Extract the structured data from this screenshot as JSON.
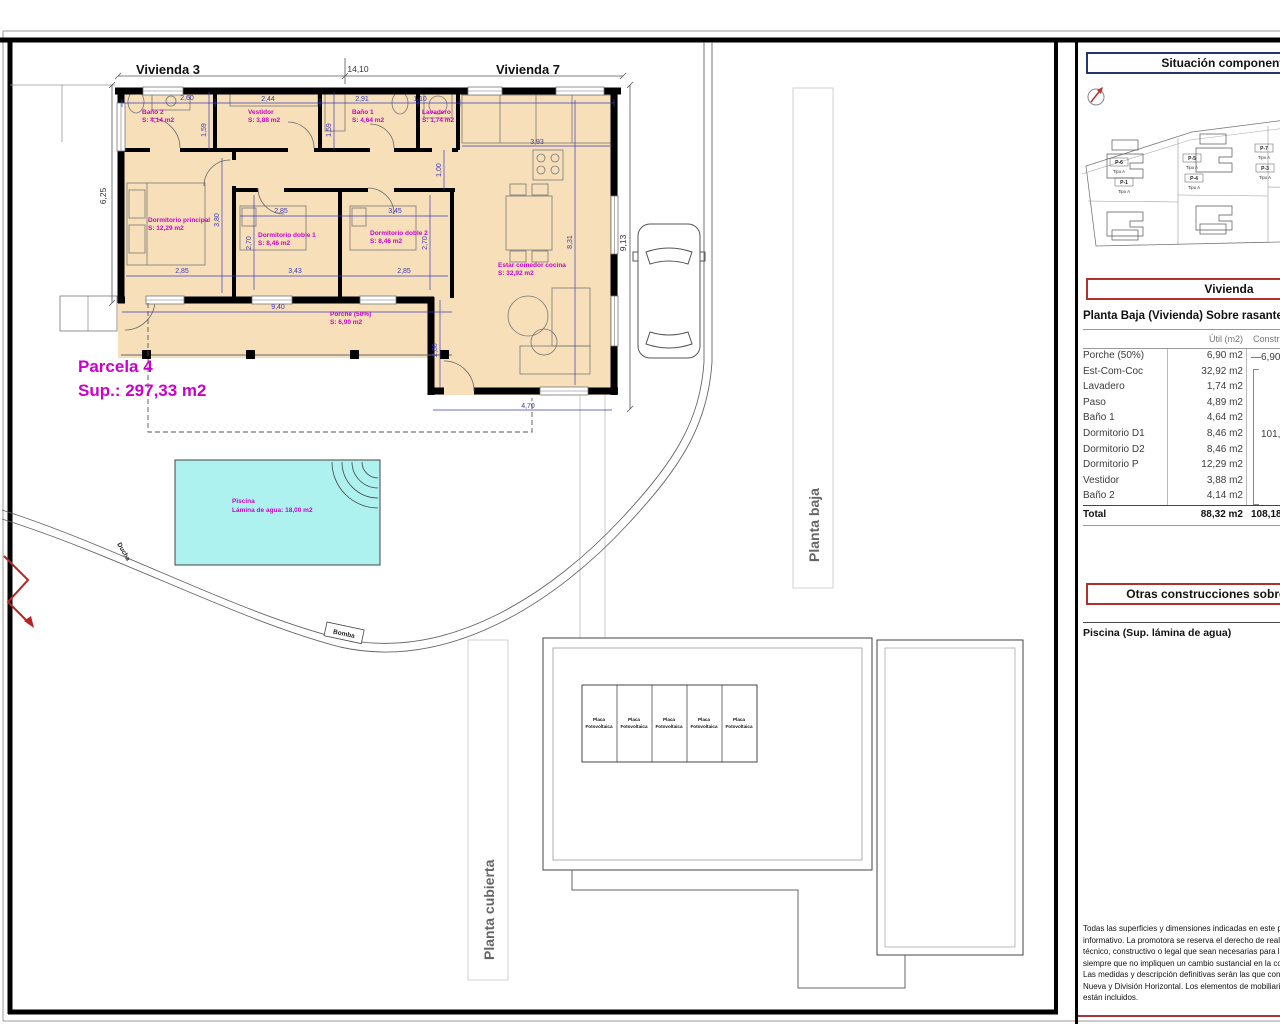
{
  "colors": {
    "room_label_magenta": "#cc00cc",
    "dimension_blue": "#3b3bbb",
    "pool_cyan": "#aef2f0",
    "floor_peach": "#f7dfba",
    "wall_black": "#000000",
    "header_navy_border": "#23366e",
    "header_red_border": "#b03030",
    "north_arrow_red": "#bb3333"
  },
  "plan": {
    "titles": {
      "vivienda3": "Vivienda 3",
      "vivienda7": "Vivienda 7"
    },
    "parcela": {
      "name": "Parcela 4",
      "area": "Sup.: 297,33 m2"
    },
    "rooms": [
      {
        "name": "Baño 2",
        "area": "S: 4,14 m2"
      },
      {
        "name": "Vestidor",
        "area": "S: 3,88 m2"
      },
      {
        "name": "Baño 1",
        "area": "S: 4,64 m2"
      },
      {
        "name": "Lavadero",
        "area": "S: 1,74 m2"
      },
      {
        "name": "Dormitorio principal",
        "area": "S: 12,29 m2"
      },
      {
        "name": "Dormitorio doble 1",
        "area": "S: 8,46 m2"
      },
      {
        "name": "Dormitorio doble 2",
        "area": "S: 8,46 m2"
      },
      {
        "name": "Estar comedor cocina",
        "area": "S: 32,92 m2"
      },
      {
        "name": "Porche (50%)",
        "area": "S: 6,90 m2"
      }
    ],
    "pool": {
      "name": "Piscina",
      "area": "Lámina de agua: 18,00 m2"
    },
    "site_labels": {
      "ducha": "Ducha",
      "bomba": "Bomba"
    },
    "view_labels": {
      "planta_baja": "Planta baja",
      "planta_cubierta": "Planta cubierta"
    },
    "solar": {
      "line1": "Placa",
      "line2": "Fotovoltaica"
    },
    "dims": [
      "14,10",
      "6,25",
      "9,13",
      "2,60",
      "2,44",
      "2,91",
      "1,10",
      "3,93",
      "1,59",
      "1,59",
      "1,00",
      "3,80",
      "2,85",
      "2,70",
      "3,43",
      "3,45",
      "2,70",
      "2,85",
      "2,85",
      "9,40",
      "8,31",
      "2,80",
      "4,70"
    ]
  },
  "panel": {
    "situacion_title": "Situación componentes",
    "site_plan": {
      "plots": [
        {
          "id": "P-6",
          "tipo": "Tipo A"
        },
        {
          "id": "P-1",
          "tipo": "Tipo A"
        },
        {
          "id": "P-5",
          "tipo": "Tipo A"
        },
        {
          "id": "P-4",
          "tipo": "Tipo A"
        },
        {
          "id": "P-7",
          "tipo": "Tipo A"
        },
        {
          "id": "P-3",
          "tipo": "Tipo A"
        }
      ]
    },
    "vivienda_title": "Vivienda",
    "planta_baja_heading": "Planta Baja (Vivienda) Sobre rasante",
    "table": {
      "col_util": "Útil (m2)",
      "col_construido": "Construido (m2)",
      "rows": [
        {
          "label": "Porche (50%)",
          "util": "6,90 m2"
        },
        {
          "label": "Est-Com-Coc",
          "util": "32,92 m2"
        },
        {
          "label": "Lavadero",
          "util": "1,74 m2"
        },
        {
          "label": "Paso",
          "util": "4,89 m2"
        },
        {
          "label": "Baño 1",
          "util": "4,64 m2"
        },
        {
          "label": "Dormitorio D1",
          "util": "8,46 m2"
        },
        {
          "label": "Dormitorio D2",
          "util": "8,46 m2"
        },
        {
          "label": "Dormitorio P",
          "util": "12,29 m2"
        },
        {
          "label": "Vestidor",
          "util": "3,88 m2"
        },
        {
          "label": "Baño 2",
          "util": "4,14 m2"
        }
      ],
      "porche_dash": "—",
      "porche_construido": "6,90 m2",
      "group_construido": "101,28 m2",
      "total_label": "Total",
      "total_util": "88,32 m2",
      "total_construido": "108,18 m2"
    },
    "otras_title": "Otras construcciones sobre rasante",
    "piscina_line": "Piscina (Sup. lámina de agua)",
    "disclaimer_lines": [
      "Todas las superficies y dimensiones indicadas en este plan",
      "informativo. La promotora se reserva el derecho de realiza",
      "técnico, constructivo o legal que sean necesarias para la",
      "siempre que no impliquen un cambio sustancial en la config",
      "Las medidas y descripción definitivas serán las que consten",
      "Nueva y División Horizontal. Los elementos de mobiliario y",
      "están incluidos."
    ]
  }
}
